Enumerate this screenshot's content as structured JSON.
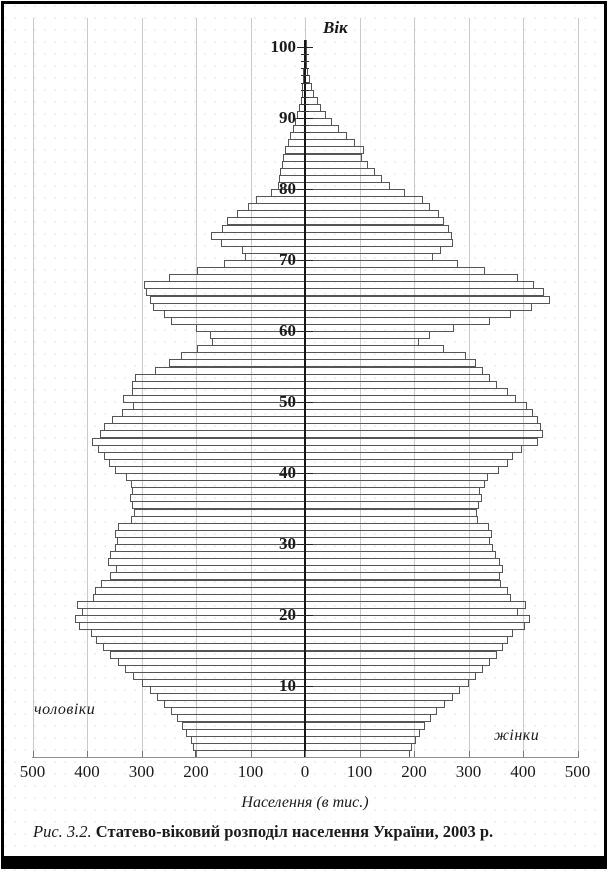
{
  "figure": {
    "age_axis_label": "Вік",
    "left_group_label": "чоловіки",
    "right_group_label": "жінки",
    "x_axis_title": "Населення (в тис.)",
    "caption_prefix": "Рис. 3.2.",
    "caption_text": "Статево-віковий розподіл населення України, 2003 р.",
    "x_tick_labels": [
      "500",
      "400",
      "300",
      "200",
      "100",
      "0",
      "100",
      "200",
      "300",
      "400",
      "500"
    ],
    "age_tick_labels": [
      "10",
      "20",
      "30",
      "40",
      "50",
      "60",
      "70",
      "80",
      "90",
      "100"
    ]
  },
  "colors": {
    "bar_outline": "#555555",
    "axis": "#161616",
    "gridline": "#c9c9c9",
    "text": "#1a1a1a",
    "frame": "#000000",
    "background": "#ffffff"
  },
  "chart_data": {
    "type": "bar",
    "subtype": "population-pyramid",
    "orientation": "horizontal",
    "title": "Статево-віковий розподіл населення України, 2003 р.",
    "xlabel": "Населення (в тис.)",
    "ylabel": "Вік",
    "units": "thousands of persons per single year of age",
    "age_range": [
      0,
      100
    ],
    "x_range_thousands": [
      -500,
      500
    ],
    "grid": "vertical gridlines every 100 thousand, from -500 to 500",
    "legend_position": "none (side labels: чоловіки left, жінки right)",
    "series": [
      {
        "name": "чоловіки",
        "side": "left",
        "values_by_age_0_to_100": [
          202,
          205,
          210,
          218,
          226,
          234,
          245,
          258,
          272,
          284,
          300,
          316,
          330,
          344,
          357,
          370,
          383,
          392,
          414,
          422,
          409,
          418,
          389,
          385,
          374,
          358,
          347,
          362,
          358,
          349,
          345,
          349,
          343,
          320,
          314,
          317,
          321,
          317,
          320,
          328,
          348,
          360,
          369,
          380,
          391,
          376,
          369,
          354,
          336,
          315,
          334,
          318,
          318,
          312,
          275,
          250,
          228,
          198,
          170,
          175,
          200,
          245,
          258,
          278,
          285,
          292,
          295,
          250,
          198,
          149,
          111,
          116,
          155,
          173,
          153,
          144,
          125,
          105,
          89,
          62,
          50,
          48,
          45,
          42,
          40,
          37,
          32,
          27,
          22,
          18,
          14,
          11,
          8,
          6,
          5,
          4,
          3,
          2,
          1.5,
          1,
          0.7
        ]
      },
      {
        "name": "жінки",
        "side": "right",
        "values_by_age_0_to_100": [
          192,
          196,
          203,
          211,
          221,
          231,
          242,
          256,
          271,
          284,
          300,
          314,
          327,
          340,
          352,
          364,
          373,
          382,
          404,
          413,
          391,
          406,
          378,
          373,
          360,
          358,
          364,
          358,
          350,
          345,
          340,
          343,
          338,
          318,
          315,
          320,
          324,
          322,
          330,
          336,
          356,
          372,
          382,
          398,
          428,
          436,
          433,
          428,
          418,
          408,
          388,
          372,
          352,
          340,
          327,
          313,
          296,
          255,
          209,
          230,
          273,
          340,
          378,
          417,
          449,
          438,
          420,
          390,
          330,
          280,
          235,
          250,
          272,
          270,
          265,
          255,
          245,
          230,
          216,
          184,
          156,
          142,
          128,
          115,
          104,
          108,
          92,
          77,
          63,
          50,
          39,
          30,
          23,
          17,
          12,
          9,
          6,
          4,
          3,
          2,
          1.2
        ]
      }
    ],
    "annotations": [
      "deep notch at ages 58-60 (WWII birth cohorts)",
      "notch at ages 70-71 (1932-33 famine cohorts)",
      "peaks near ages 44-46 and 63-66 and 18-21"
    ]
  }
}
